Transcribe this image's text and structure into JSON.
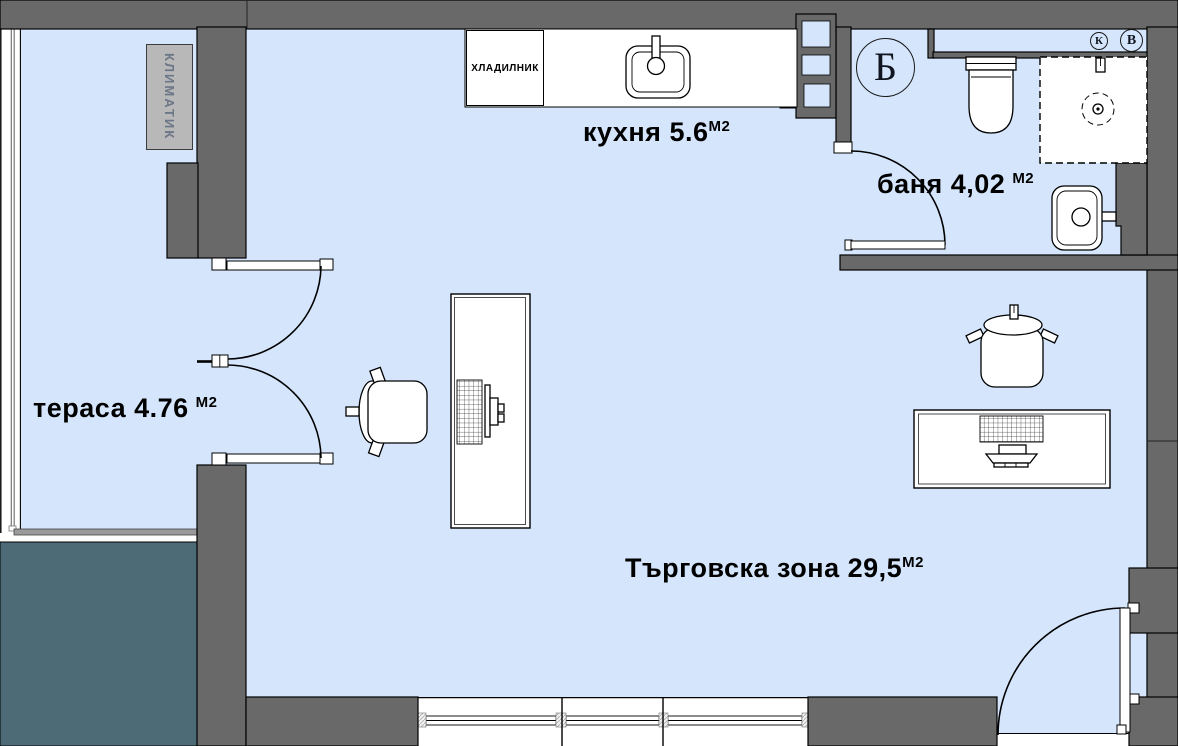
{
  "colors": {
    "floor": "#d5e6fc",
    "wall": "#696969",
    "outside": "#4d6b77",
    "ac_box": "#b8b8b8"
  },
  "rooms": {
    "kitchen": {
      "label": "кухня 5.6",
      "unit": "М2"
    },
    "bath": {
      "label": "баня 4,02",
      "unit": "М2"
    },
    "terrace": {
      "label": "тераса 4.76",
      "unit": "М2"
    },
    "commercial": {
      "label": "Търговска зона 29,5",
      "unit": "М2"
    }
  },
  "labels": {
    "fridge": "ХЛАДИЛНИК",
    "air_conditioner": "КЛИМАТИК"
  },
  "markers": {
    "section": "Б",
    "riser_k": "К",
    "riser_v": "В"
  }
}
